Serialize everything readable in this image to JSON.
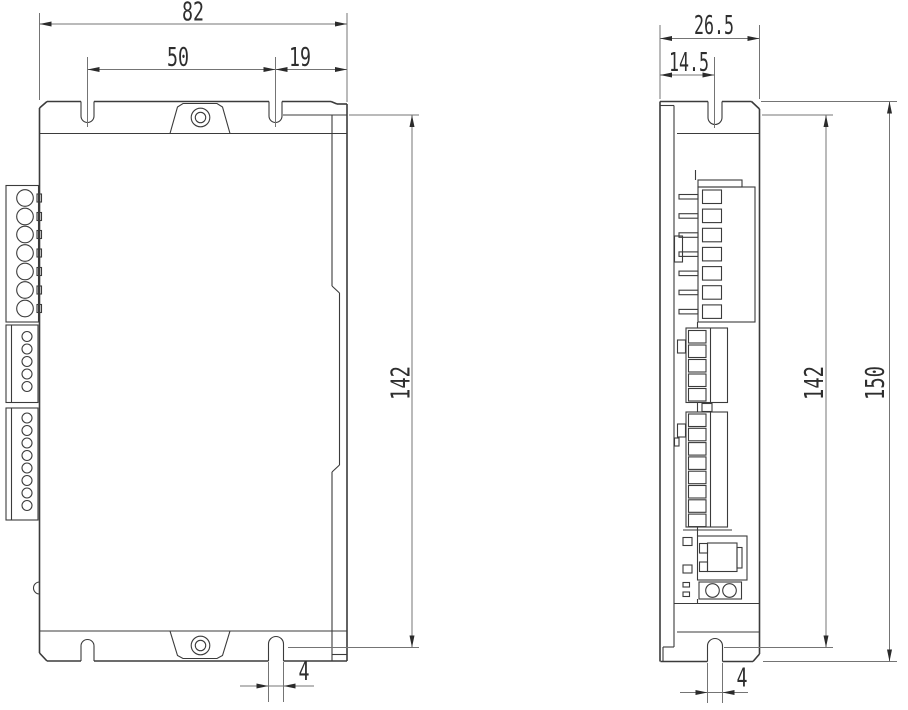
{
  "drawing": {
    "type": "mechanical-dimension-drawing",
    "views": [
      "front",
      "side"
    ],
    "front": {
      "width": "82",
      "slot_spacing": "50",
      "slot_to_edge": "19",
      "flange_height": "142",
      "slot_width": "4",
      "power_terminal_holes": 7,
      "connector_a_holes": 5,
      "connector_b_holes": 8
    },
    "side": {
      "depth": "26.5",
      "slot_offset": "14.5",
      "flange_height": "142",
      "overall_height": "150",
      "slot_width": "4",
      "terminal_positions": 7,
      "connector_a_positions": 5,
      "connector_b_positions": 8,
      "indicator_holes": 2
    }
  }
}
